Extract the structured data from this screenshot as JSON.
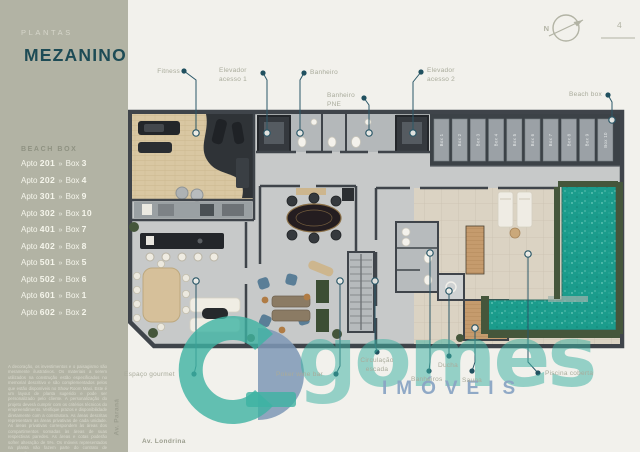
{
  "sidebar": {
    "eyebrow": "PLANTAS",
    "title": "MEZANINO",
    "list_header": "BEACH BOX",
    "apto_label": "Apto",
    "box_label": "Box",
    "separator": "»",
    "apartments": [
      {
        "apto": "201",
        "box": "3"
      },
      {
        "apto": "202",
        "box": "4"
      },
      {
        "apto": "301",
        "box": "9"
      },
      {
        "apto": "302",
        "box": "10"
      },
      {
        "apto": "401",
        "box": "7"
      },
      {
        "apto": "402",
        "box": "8"
      },
      {
        "apto": "501",
        "box": "5"
      },
      {
        "apto": "502",
        "box": "6"
      },
      {
        "apto": "601",
        "box": "1"
      },
      {
        "apto": "602",
        "box": "2"
      }
    ],
    "disclaimer": "A decoração, os investimentos e o paisagismo são meramente ilustrativos. Os materiais a serem utilizados na construção estão especificados no memorial descritivo e são complementados pelos que estão disponíveis no Show Room Maxi. Este é um layout de planta sugerido e pode ser personalizado pelo cliente. A personalização do projeto deverá cumprir com os critérios técnicos do empreendimento. Verifique prazos e disponibilidade diretamente com a construtora. As áreas descritas representam as áreas privativas de cada unidade. As áreas privativas correspondem às áreas dos compartimentos somadas às áreas de suas respectivas paredes. As áreas e cotas poderão sofrer alteração de 5%. Os móveis representados na planta não fazem parte do contrato de construção."
  },
  "header": {
    "compass_label": "N",
    "page_number": "4"
  },
  "plan": {
    "labels": {
      "fitness": "Fitness",
      "elevador1": "Elevador\nacesso 1",
      "banheiro": "Banheiro",
      "banheiro_pne": "Banheiro\nPNE",
      "elevador2": "Elevador\nacesso 2",
      "beach_box": "Beach box",
      "espaco_gourmet": "Espaço gourmet",
      "poker": "Poker wine bar",
      "circulacao": "Circulação\nescada",
      "banheiros": "Banheiros",
      "ducha": "Ducha",
      "sauna": "Sauna",
      "piscina": "Piscina coberta",
      "av_parana": "Av. Paraná",
      "av_londrina": "Av. Londrina"
    },
    "beach_boxes": [
      "Box 1",
      "Box 2",
      "Box 3",
      "Box 4",
      "Box 5",
      "Box 6",
      "Box 7",
      "Box 8",
      "Box 9",
      "Box 10"
    ]
  },
  "watermark": {
    "brand": "gomes",
    "brand_sub": "IMÓVEIS"
  },
  "colors": {
    "sidebar_bg": "#b2b3a4",
    "title_teal": "#1d4b55",
    "callout_line": "#2b5868",
    "pool_teal": "#1b9c8c",
    "watermark_teal": "#3db3a2",
    "watermark_blue": "#8ba5c5"
  }
}
